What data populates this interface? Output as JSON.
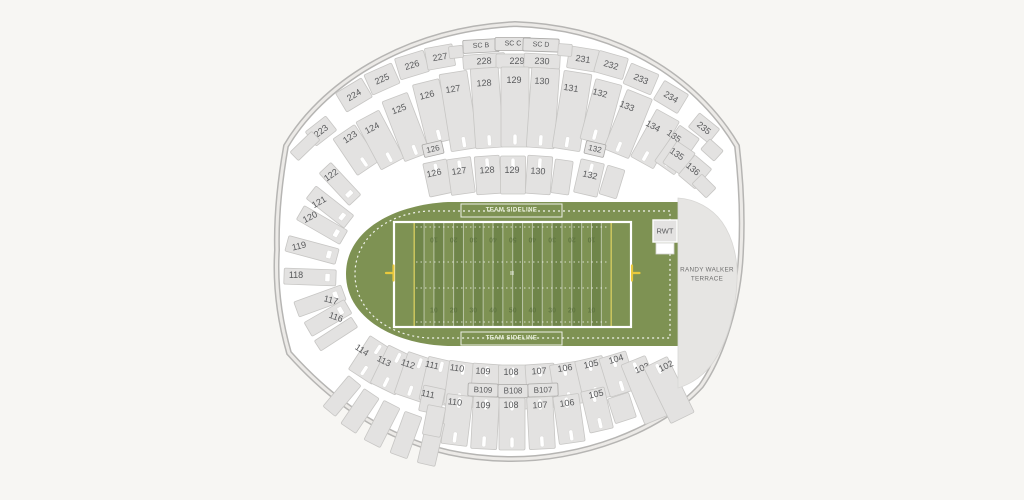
{
  "colors": {
    "background": "#f7f6f3",
    "section_fill": "#e3e2e1",
    "field_green": "#7e9253",
    "field_stripe_dark": "#6f8549",
    "goalpost_yellow": "#e9c93c",
    "label_text": "#58595b"
  },
  "field": {
    "sideline_label": "TEAM SIDELINE",
    "yard_numbers": [
      "10",
      "20",
      "30",
      "40",
      "50",
      "40",
      "30",
      "20",
      "10"
    ],
    "rwt_label": "RWT",
    "terrace_label": [
      "RANDY WALKER",
      "TERRACE"
    ]
  },
  "sections": [
    {
      "label": "223",
      "cx": 321,
      "cy": 131,
      "w": 26,
      "h": 18,
      "r": -38
    },
    {
      "label": "224",
      "cx": 354,
      "cy": 95,
      "w": 30,
      "h": 22,
      "r": -31
    },
    {
      "label": "225",
      "cx": 382,
      "cy": 79,
      "w": 30,
      "h": 22,
      "r": -24
    },
    {
      "label": "226",
      "cx": 412,
      "cy": 65,
      "w": 30,
      "h": 22,
      "r": -17
    },
    {
      "label": "227",
      "cx": 440,
      "cy": 57,
      "w": 28,
      "h": 22,
      "r": -10
    },
    {
      "label": "228",
      "cx": 484,
      "cy": 61,
      "w": 42,
      "h": 14,
      "r": -4
    },
    {
      "label": "229",
      "cx": 517,
      "cy": 61,
      "w": 42,
      "h": 14,
      "r": 0
    },
    {
      "label": "230",
      "cx": 542,
      "cy": 61,
      "w": 36,
      "h": 14,
      "r": 3
    },
    {
      "label": "231",
      "cx": 583,
      "cy": 59,
      "w": 30,
      "h": 22,
      "r": 9
    },
    {
      "label": "232",
      "cx": 611,
      "cy": 65,
      "w": 30,
      "h": 22,
      "r": 16
    },
    {
      "label": "233",
      "cx": 641,
      "cy": 79,
      "w": 30,
      "h": 22,
      "r": 23
    },
    {
      "label": "234",
      "cx": 671,
      "cy": 97,
      "w": 28,
      "h": 22,
      "r": 31
    },
    {
      "label": "235",
      "cx": 704,
      "cy": 128,
      "w": 26,
      "h": 18,
      "r": 39
    },
    {
      "label": "SC B",
      "cx": 481,
      "cy": 46,
      "w": 36,
      "h": 13,
      "r": -3,
      "fs": 7,
      "b": 1
    },
    {
      "label": "SC C",
      "cx": 513,
      "cy": 44,
      "w": 36,
      "h": 13,
      "r": 0,
      "fs": 7,
      "b": 1
    },
    {
      "label": "SC D",
      "cx": 541,
      "cy": 45,
      "w": 36,
      "h": 13,
      "r": 2,
      "fs": 7,
      "b": 1
    },
    {
      "label": "123",
      "cx": 356,
      "cy": 150,
      "w": 26,
      "h": 44,
      "r": -34,
      "lx": 350,
      "ly": 137,
      "s": 1
    },
    {
      "label": "124",
      "cx": 380,
      "cy": 140,
      "w": 26,
      "h": 54,
      "r": -28,
      "lx": 372,
      "ly": 128,
      "s": 1
    },
    {
      "label": "125",
      "cx": 406,
      "cy": 127,
      "w": 27,
      "h": 64,
      "r": -21,
      "lx": 399,
      "ly": 109,
      "s": 1
    },
    {
      "label": "126",
      "cx": 433,
      "cy": 112,
      "w": 27,
      "h": 62,
      "r": -14,
      "lx": 427,
      "ly": 95,
      "s": 1
    },
    {
      "label": "127",
      "cx": 459,
      "cy": 111,
      "w": 28,
      "h": 78,
      "r": -9,
      "lx": 453,
      "ly": 89,
      "s": 1
    },
    {
      "label": "128",
      "cx": 487,
      "cy": 108,
      "w": 28,
      "h": 80,
      "r": -4,
      "lx": 484,
      "ly": 83,
      "s": 1
    },
    {
      "label": "129",
      "cx": 515,
      "cy": 107,
      "w": 28,
      "h": 80,
      "r": 0,
      "lx": 514,
      "ly": 80,
      "s": 1
    },
    {
      "label": "130",
      "cx": 543,
      "cy": 108,
      "w": 28,
      "h": 80,
      "r": 4,
      "lx": 542,
      "ly": 81,
      "s": 1
    },
    {
      "label": "131",
      "cx": 572,
      "cy": 111,
      "w": 28,
      "h": 78,
      "r": 9,
      "lx": 571,
      "ly": 88,
      "s": 1
    },
    {
      "label": "132",
      "cx": 601,
      "cy": 112,
      "w": 27,
      "h": 62,
      "r": 15,
      "lx": 600,
      "ly": 93,
      "s": 1
    },
    {
      "label": "133",
      "cx": 628,
      "cy": 124,
      "w": 27,
      "h": 64,
      "r": 22,
      "lx": 627,
      "ly": 106,
      "s": 1
    },
    {
      "label": "134",
      "cx": 655,
      "cy": 139,
      "w": 26,
      "h": 54,
      "r": 29,
      "lx": 653,
      "ly": 126,
      "s": 1
    },
    {
      "label": "135",
      "cx": 677,
      "cy": 150,
      "w": 24,
      "h": 44,
      "r": 35,
      "lx": 674,
      "ly": 136,
      "s": 1
    },
    {
      "label": "126",
      "cx": 433,
      "cy": 149,
      "w": 20,
      "h": 13,
      "r": -13,
      "fs": 8,
      "b": 1
    },
    {
      "label": "132",
      "cx": 595,
      "cy": 149,
      "w": 20,
      "h": 13,
      "r": 13,
      "fs": 8,
      "b": 1
    },
    {
      "label": "126",
      "cx": 438,
      "cy": 178,
      "w": 24,
      "h": 34,
      "r": -12,
      "lx": 434,
      "ly": 173,
      "s": 2
    },
    {
      "label": "127",
      "cx": 461,
      "cy": 176,
      "w": 24,
      "h": 36,
      "r": -8,
      "lx": 459,
      "ly": 171,
      "s": 2
    },
    {
      "label": "128",
      "cx": 488,
      "cy": 175,
      "w": 25,
      "h": 38,
      "r": -4,
      "lx": 487,
      "ly": 170,
      "s": 2
    },
    {
      "label": "129",
      "cx": 513,
      "cy": 175,
      "w": 25,
      "h": 38,
      "r": 0,
      "lx": 512,
      "ly": 170,
      "s": 2
    },
    {
      "label": "130",
      "cx": 539,
      "cy": 175,
      "w": 25,
      "h": 38,
      "r": 4,
      "lx": 538,
      "ly": 171,
      "s": 2
    },
    {
      "cx": 562,
      "cy": 177,
      "w": 18,
      "h": 34,
      "r": 8
    },
    {
      "label": "132",
      "cx": 589,
      "cy": 178,
      "w": 24,
      "h": 34,
      "r": 13,
      "lx": 590,
      "ly": 175,
      "s": 2
    },
    {
      "cx": 612,
      "cy": 182,
      "w": 18,
      "h": 30,
      "r": 17
    },
    {
      "label": "135",
      "cx": 679,
      "cy": 158,
      "w": 22,
      "h": 26,
      "r": 34,
      "lx": 677,
      "ly": 154
    },
    {
      "label": "136",
      "cx": 695,
      "cy": 172,
      "w": 22,
      "h": 26,
      "r": 40,
      "lx": 693,
      "ly": 169
    },
    {
      "label": "122",
      "cx": 340,
      "cy": 184,
      "w": 44,
      "h": 16,
      "r": 47,
      "lx": 331,
      "ly": 175,
      "tr": -35,
      "s": 4
    },
    {
      "label": "121",
      "cx": 330,
      "cy": 207,
      "w": 48,
      "h": 16,
      "r": 38,
      "lx": 319,
      "ly": 202,
      "tr": -30,
      "s": 4
    },
    {
      "label": "120",
      "cx": 322,
      "cy": 225,
      "w": 50,
      "h": 16,
      "r": 30,
      "lx": 310,
      "ly": 217,
      "tr": -27,
      "s": 4
    },
    {
      "label": "119",
      "cx": 312,
      "cy": 250,
      "w": 52,
      "h": 16,
      "r": 15,
      "lx": 299,
      "ly": 246,
      "tr": -14,
      "s": 4
    },
    {
      "label": "118",
      "cx": 310,
      "cy": 277,
      "w": 52,
      "h": 16,
      "r": 2,
      "lx": 296,
      "ly": 275,
      "tr": 0,
      "s": 4
    },
    {
      "label": "117",
      "cx": 320,
      "cy": 301,
      "w": 50,
      "h": 16,
      "r": -20,
      "lx": 331,
      "ly": 300,
      "tr": 14,
      "s": 4
    },
    {
      "label": "116",
      "cx": 328,
      "cy": 318,
      "w": 46,
      "h": 16,
      "r": -30,
      "lx": 336,
      "ly": 317,
      "tr": 20,
      "s": 4
    },
    {
      "label": "114",
      "cx": 371,
      "cy": 360,
      "w": 28,
      "h": 40,
      "r": 33,
      "lx": 362,
      "ly": 350,
      "s": 3
    },
    {
      "label": "113",
      "cx": 392,
      "cy": 370,
      "w": 28,
      "h": 42,
      "r": 26,
      "lx": 384,
      "ly": 361,
      "s": 3
    },
    {
      "label": "112",
      "cx": 415,
      "cy": 377,
      "w": 29,
      "h": 44,
      "r": 19,
      "lx": 408,
      "ly": 364,
      "s": 3
    },
    {
      "label": "111",
      "cx": 438,
      "cy": 381,
      "w": 29,
      "h": 44,
      "r": 13,
      "lx": 432,
      "ly": 365,
      "s": 3
    },
    {
      "label": "110",
      "cx": 461,
      "cy": 384,
      "w": 29,
      "h": 44,
      "r": 8,
      "lx": 457,
      "ly": 368,
      "s": 3
    },
    {
      "label": "109",
      "cx": 486,
      "cy": 386,
      "w": 29,
      "h": 44,
      "r": 4,
      "lx": 483,
      "ly": 371,
      "s": 3
    },
    {
      "label": "108",
      "cx": 513,
      "cy": 387,
      "w": 29,
      "h": 44,
      "r": 0,
      "lx": 511,
      "ly": 372,
      "s": 3
    },
    {
      "label": "107",
      "cx": 541,
      "cy": 386,
      "w": 29,
      "h": 44,
      "r": -4,
      "lx": 539,
      "ly": 371,
      "s": 3
    },
    {
      "label": "106",
      "cx": 567,
      "cy": 384,
      "w": 29,
      "h": 42,
      "r": -9,
      "lx": 565,
      "ly": 368,
      "s": 3
    },
    {
      "label": "105",
      "cx": 593,
      "cy": 379,
      "w": 28,
      "h": 42,
      "r": -13,
      "lx": 591,
      "ly": 364,
      "s": 3
    },
    {
      "label": "104",
      "cx": 618,
      "cy": 374,
      "w": 28,
      "h": 40,
      "r": -17,
      "lx": 616,
      "ly": 359,
      "s": 3
    },
    {
      "label": "103",
      "cx": 645,
      "cy": 390,
      "w": 26,
      "h": 64,
      "r": -22,
      "lx": 642,
      "ly": 368,
      "s": 2
    },
    {
      "label": "102",
      "cx": 669,
      "cy": 390,
      "w": 26,
      "h": 62,
      "r": -26,
      "lx": 666,
      "ly": 366,
      "s": 2
    },
    {
      "label": "B109",
      "cx": 483,
      "cy": 390,
      "w": 30,
      "h": 13,
      "r": 2,
      "fs": 8,
      "b": 1
    },
    {
      "label": "B108",
      "cx": 513,
      "cy": 391,
      "w": 30,
      "h": 13,
      "r": 0,
      "fs": 8,
      "b": 1
    },
    {
      "label": "B107",
      "cx": 543,
      "cy": 390,
      "w": 30,
      "h": 13,
      "r": -2,
      "fs": 8,
      "b": 1
    },
    {
      "label": "111",
      "cx": 432,
      "cy": 400,
      "w": 22,
      "h": 26,
      "r": 12,
      "lx": 428,
      "ly": 394
    },
    {
      "label": "110",
      "cx": 457,
      "cy": 420,
      "w": 26,
      "h": 50,
      "r": 7,
      "lx": 455,
      "ly": 402,
      "s": 3
    },
    {
      "label": "109",
      "cx": 485,
      "cy": 423,
      "w": 26,
      "h": 52,
      "r": 3,
      "lx": 483,
      "ly": 405,
      "s": 3
    },
    {
      "label": "108",
      "cx": 512,
      "cy": 424,
      "w": 26,
      "h": 52,
      "r": 0,
      "lx": 511,
      "ly": 405,
      "s": 3
    },
    {
      "label": "107",
      "cx": 541,
      "cy": 423,
      "w": 26,
      "h": 52,
      "r": -3,
      "lx": 540,
      "ly": 405,
      "s": 3
    },
    {
      "label": "106",
      "cx": 569,
      "cy": 419,
      "w": 26,
      "h": 48,
      "r": -8,
      "lx": 567,
      "ly": 403,
      "s": 3
    },
    {
      "label": "105",
      "cx": 597,
      "cy": 410,
      "w": 24,
      "h": 42,
      "r": -13,
      "lx": 596,
      "ly": 394,
      "s": 3
    },
    {
      "cx": 456,
      "cy": 52,
      "w": 14,
      "h": 12,
      "r": -6
    },
    {
      "cx": 565,
      "cy": 50,
      "w": 14,
      "h": 12,
      "r": 4
    },
    {
      "cx": 305,
      "cy": 146,
      "w": 30,
      "h": 12,
      "r": -44
    },
    {
      "cx": 336,
      "cy": 334,
      "w": 44,
      "h": 12,
      "r": -33
    },
    {
      "cx": 342,
      "cy": 396,
      "w": 16,
      "h": 40,
      "r": 40
    },
    {
      "cx": 360,
      "cy": 411,
      "w": 18,
      "h": 42,
      "r": 34
    },
    {
      "cx": 382,
      "cy": 424,
      "w": 18,
      "h": 44,
      "r": 27
    },
    {
      "cx": 406,
      "cy": 435,
      "w": 18,
      "h": 44,
      "r": 20
    },
    {
      "cx": 431,
      "cy": 443,
      "w": 18,
      "h": 44,
      "r": 13
    },
    {
      "cx": 434,
      "cy": 421,
      "w": 18,
      "h": 30,
      "r": 11
    },
    {
      "cx": 622,
      "cy": 408,
      "w": 22,
      "h": 26,
      "r": -18
    },
    {
      "cx": 712,
      "cy": 150,
      "w": 18,
      "h": 14,
      "r": 42
    },
    {
      "cx": 704,
      "cy": 186,
      "w": 20,
      "h": 14,
      "r": 45
    }
  ]
}
